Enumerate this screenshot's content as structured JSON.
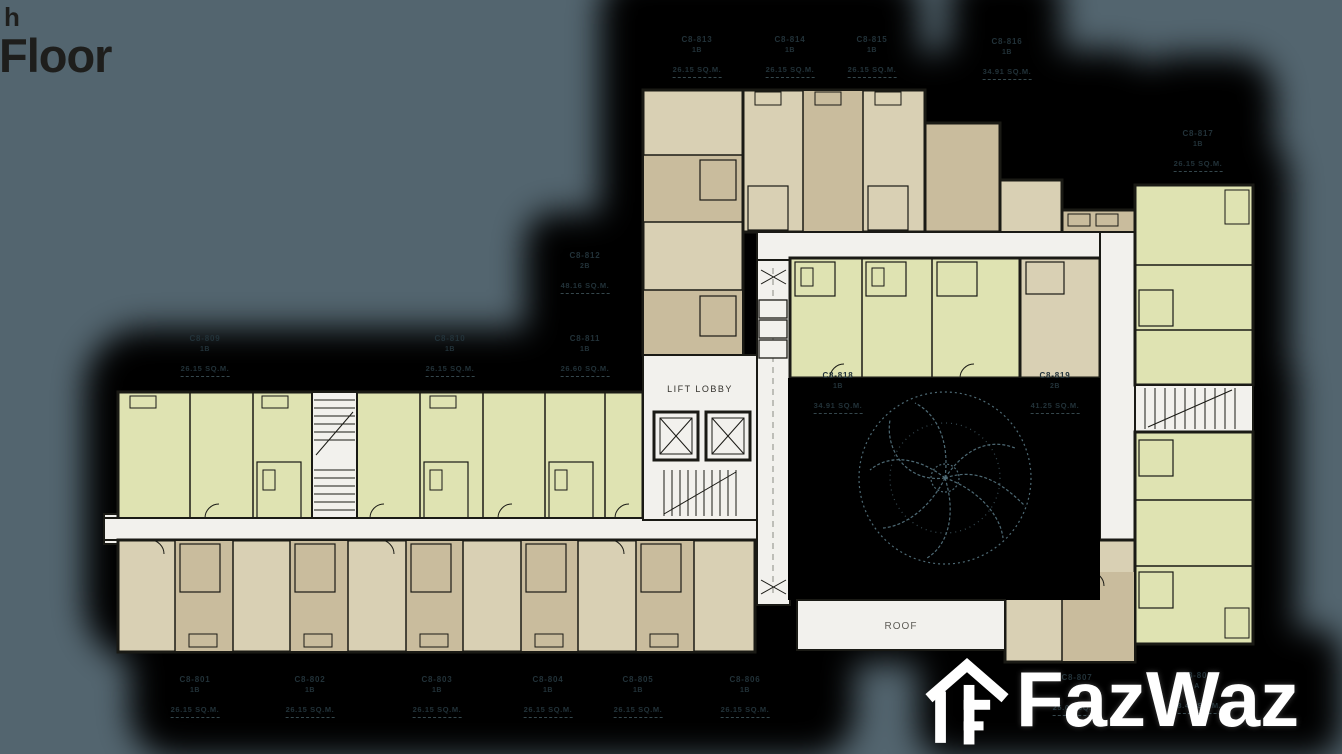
{
  "title": {
    "superscript_fragment": "h",
    "main": "Floor"
  },
  "plan": {
    "lift_lobby_label": "LIFT LOBBY",
    "roof_label": "ROOF"
  },
  "watermark": {
    "brand": "FazWaz"
  },
  "colors": {
    "background": "#53656f",
    "shadow": "#000000",
    "corridor": "#f2f1ed",
    "unit_green": "#dfe3b2",
    "unit_tan_light": "#d9d0b4",
    "unit_tan_dark": "#c9bc9d",
    "wall": "#1a1a15",
    "label_text": "#223239",
    "tree_line": "#4e6a75",
    "logo": "#ffffff"
  },
  "unit_labels": [
    {
      "unit": "C8-813",
      "type": "1B",
      "area": "26.15 SQ.M.",
      "x": 697,
      "y": 34
    },
    {
      "unit": "C8-814",
      "type": "1B",
      "area": "26.15 SQ.M.",
      "x": 790,
      "y": 34
    },
    {
      "unit": "C8-815",
      "type": "1B",
      "area": "26.15 SQ.M.",
      "x": 872,
      "y": 34
    },
    {
      "unit": "C8-816",
      "type": "1B",
      "area": "34.91 SQ.M.",
      "x": 1007,
      "y": 36
    },
    {
      "unit": "C8-817",
      "type": "1B",
      "area": "26.15 SQ.M.",
      "x": 1198,
      "y": 128
    },
    {
      "unit": "C8-812",
      "type": "2B",
      "area": "48.16 SQ.M.",
      "x": 585,
      "y": 250
    },
    {
      "unit": "C8-809",
      "type": "1B",
      "area": "26.15 SQ.M.",
      "x": 205,
      "y": 333
    },
    {
      "unit": "C8-810",
      "type": "1B",
      "area": "26.15 SQ.M.",
      "x": 450,
      "y": 333
    },
    {
      "unit": "C8-811",
      "type": "1B",
      "area": "26.60 SQ.M.",
      "x": 585,
      "y": 333
    },
    {
      "unit": "C8-818",
      "type": "1B",
      "area": "34.91 SQ.M.",
      "x": 838,
      "y": 370
    },
    {
      "unit": "C8-819",
      "type": "2B",
      "area": "41.25 SQ.M.",
      "x": 1055,
      "y": 370
    },
    {
      "unit": "C8-801",
      "type": "1B",
      "area": "26.15 SQ.M.",
      "x": 195,
      "y": 674
    },
    {
      "unit": "C8-802",
      "type": "1B",
      "area": "26.15 SQ.M.",
      "x": 310,
      "y": 674
    },
    {
      "unit": "C8-803",
      "type": "1B",
      "area": "26.15 SQ.M.",
      "x": 437,
      "y": 674
    },
    {
      "unit": "C8-804",
      "type": "1B",
      "area": "26.15 SQ.M.",
      "x": 548,
      "y": 674
    },
    {
      "unit": "C8-805",
      "type": "1B",
      "area": "26.15 SQ.M.",
      "x": 638,
      "y": 674
    },
    {
      "unit": "C8-806",
      "type": "1B",
      "area": "26.15 SQ.M.",
      "x": 745,
      "y": 674
    },
    {
      "unit": "C8-807",
      "type": "A",
      "area": "25.08 SQ.M.",
      "x": 1077,
      "y": 672
    },
    {
      "unit": "C8-808",
      "type": "A",
      "area": "28.45 SQ.M.",
      "x": 1197,
      "y": 670
    }
  ]
}
